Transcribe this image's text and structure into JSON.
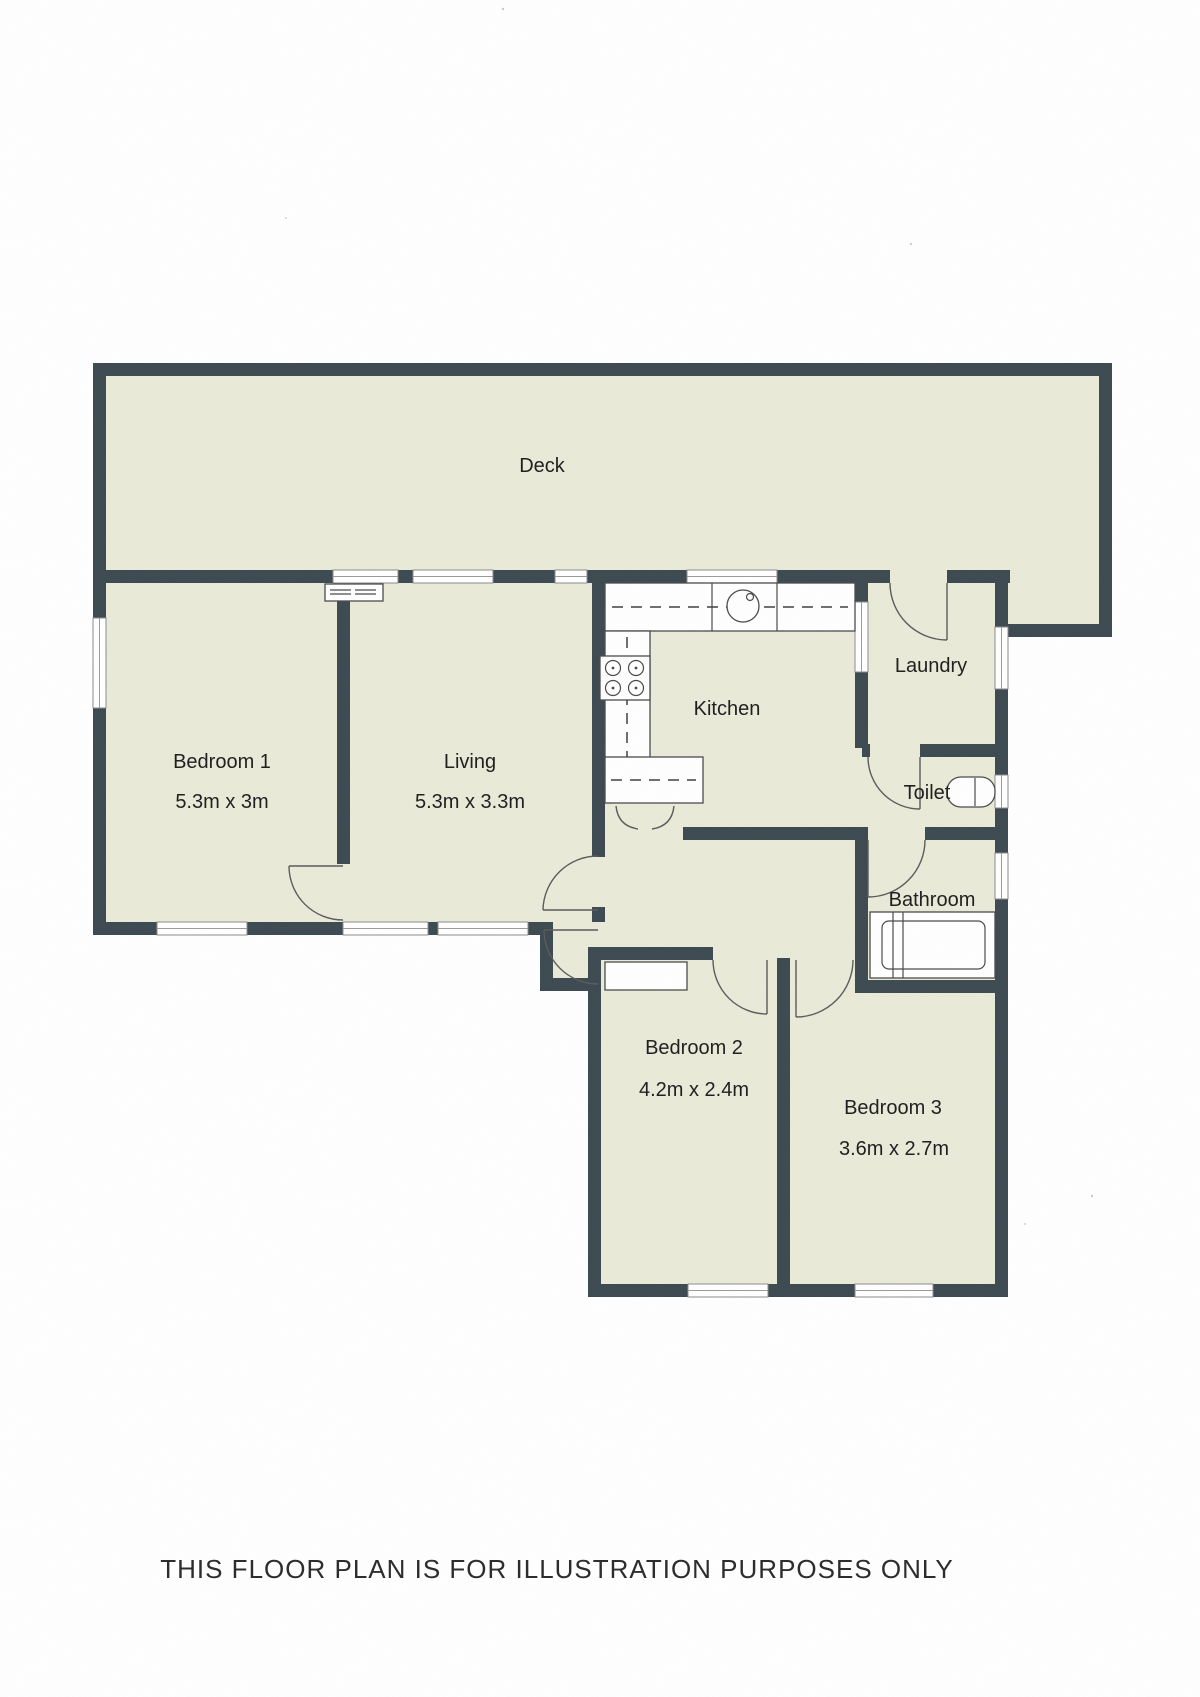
{
  "page": {
    "footer": "THIS FLOOR PLAN IS FOR ILLUSTRATION PURPOSES ONLY"
  },
  "colors": {
    "wall": "#3c4950",
    "floor": "#e9ead8",
    "window": "#ffffff",
    "paper": "#ffffff"
  },
  "rooms": {
    "deck": {
      "label": "Deck"
    },
    "bedroom1": {
      "label": "Bedroom 1",
      "dimensions": "5.3m x 3m"
    },
    "living": {
      "label": "Living",
      "dimensions": "5.3m x 3.3m"
    },
    "kitchen": {
      "label": "Kitchen"
    },
    "laundry": {
      "label": "Laundry"
    },
    "toilet": {
      "label": "Toilet"
    },
    "bathroom": {
      "label": "Bathroom"
    },
    "bedroom2": {
      "label": "Bedroom 2",
      "dimensions": "4.2m x 2.4m"
    },
    "bedroom3": {
      "label": "Bedroom 3",
      "dimensions": "3.6m x 2.7m"
    }
  }
}
